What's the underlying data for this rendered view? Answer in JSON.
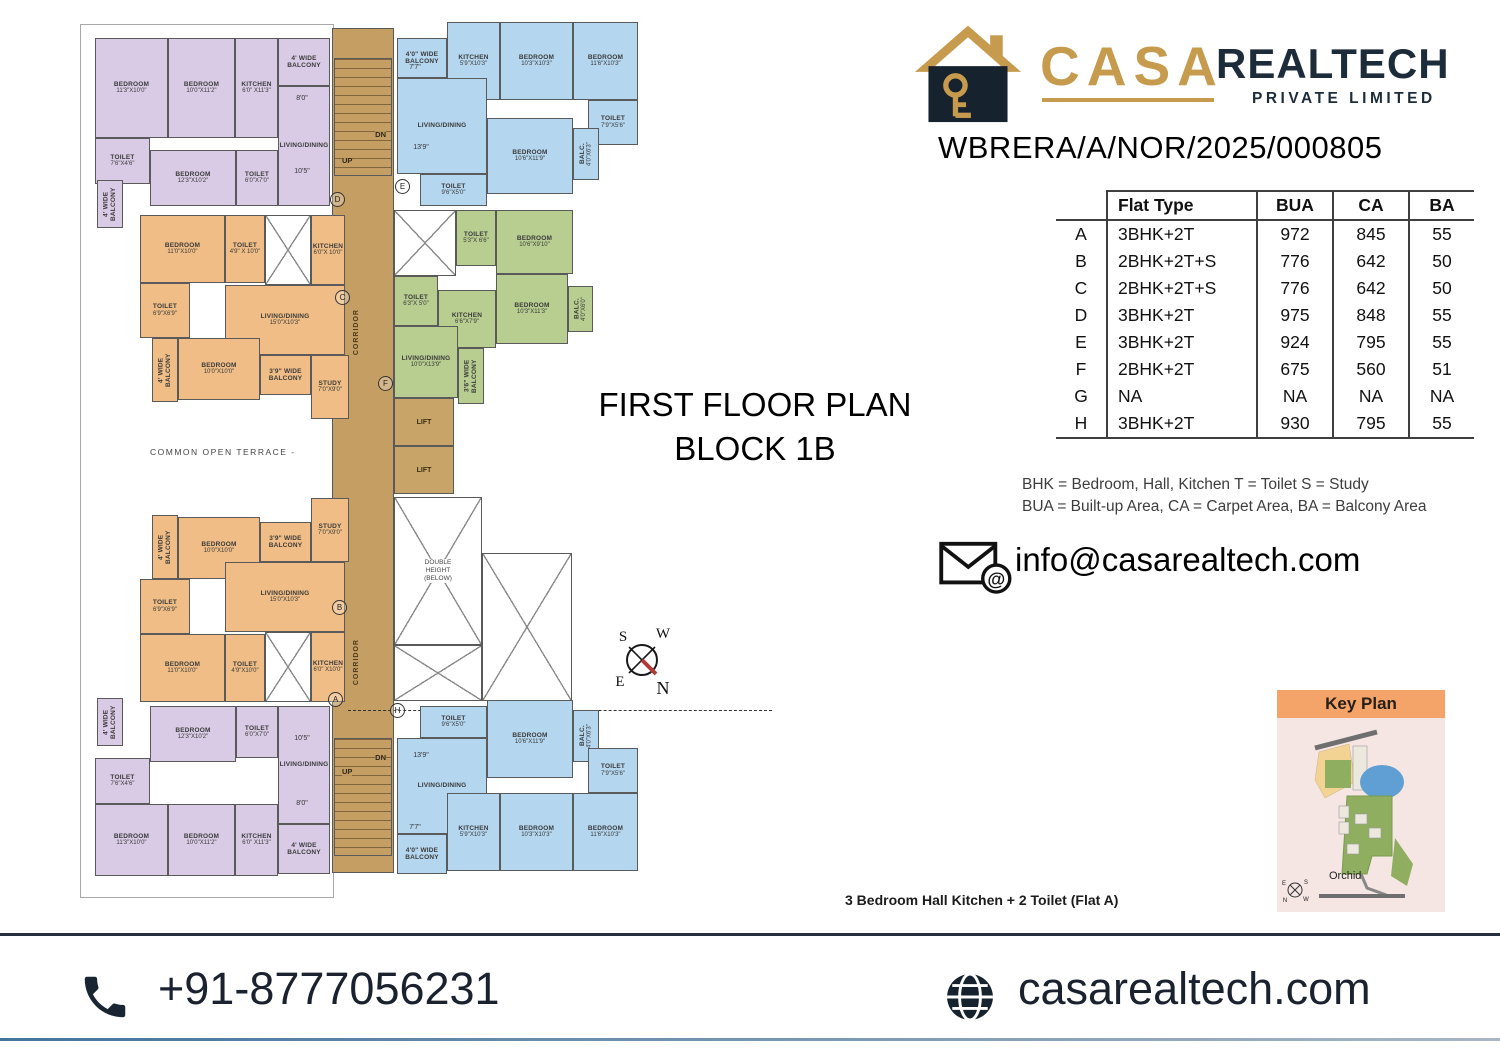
{
  "header": {
    "brand_casa": "CASA",
    "brand_realtech": "REALTECH",
    "brand_sub": "PRIVATE LIMITED",
    "rera": "WBRERA/A/NOR/2025/000805"
  },
  "area_table": {
    "columns": [
      "Flat Type",
      "BUA",
      "CA",
      "BA"
    ],
    "rows": [
      {
        "flat": "A",
        "type": "3BHK+2T",
        "bua": "972",
        "ca": "845",
        "ba": "55"
      },
      {
        "flat": "B",
        "type": "2BHK+2T+S",
        "bua": "776",
        "ca": "642",
        "ba": "50"
      },
      {
        "flat": "C",
        "type": "2BHK+2T+S",
        "bua": "776",
        "ca": "642",
        "ba": "50"
      },
      {
        "flat": "D",
        "type": "3BHK+2T",
        "bua": "975",
        "ca": "848",
        "ba": "55"
      },
      {
        "flat": "E",
        "type": "3BHK+2T",
        "bua": "924",
        "ca": "795",
        "ba": "55"
      },
      {
        "flat": "F",
        "type": "2BHK+2T",
        "bua": "675",
        "ca": "560",
        "ba": "51"
      },
      {
        "flat": "G",
        "type": "NA",
        "bua": "NA",
        "ca": "NA",
        "ba": "NA"
      },
      {
        "flat": "H",
        "type": "3BHK+2T",
        "bua": "930",
        "ca": "795",
        "ba": "55"
      }
    ]
  },
  "legend": {
    "line1": "BHK = Bedroom, Hall, Kitchen  T = Toilet  S = Study",
    "line2": "BUA = Built-up Area, CA = Carpet Area, BA = Balcony Area"
  },
  "contact": {
    "email": "info@casarealtech.com",
    "phone": "+91-8777056231",
    "website": "casarealtech.com"
  },
  "key_plan": {
    "title": "Key Plan",
    "label": "Orchid",
    "compass": {
      "tl": "E",
      "tr": "S",
      "bl": "N",
      "br": "W"
    }
  },
  "floor_plan": {
    "title_line1": "FIRST FLOOR PLAN",
    "title_line2": "BLOCK 1B",
    "caption": "3 Bedroom Hall Kitchen + 2 Toilet (Flat A)",
    "terrace_label": "COMMON  OPEN  TERRACE  -",
    "corridor_label": "CORRIDOR",
    "lift_label": "LIFT",
    "double_height_label": "DOUBLE HEIGHT (BELOW)",
    "stairs": {
      "dn": "DN",
      "up": "UP"
    },
    "compass": {
      "tl": "S",
      "tr": "W",
      "bl": "E",
      "br": "N"
    },
    "colors": {
      "p": "#d9cbe5",
      "b": "#b4d6ee",
      "g": "#b8cd90",
      "o": "#efbd85",
      "tan": "#c49e63",
      "wall": "#5a5a5a"
    },
    "rooms": [
      {
        "u": "D",
        "c": "p",
        "n": "BEDROOM",
        "d": "11'3\"X10'0\"",
        "x": 95,
        "y": 38,
        "w": 73,
        "h": 100
      },
      {
        "u": "D",
        "c": "p",
        "n": "BEDROOM",
        "d": "10'0\"X11'2\"",
        "x": 168,
        "y": 38,
        "w": 67,
        "h": 100
      },
      {
        "u": "D",
        "c": "p",
        "n": "KITCHEN",
        "d": "6'0\" X11'3\"",
        "x": 235,
        "y": 38,
        "w": 43,
        "h": 100
      },
      {
        "u": "D",
        "c": "p",
        "n": "4' WIDE BALCONY",
        "x": 278,
        "y": 38,
        "w": 52,
        "h": 48
      },
      {
        "u": "D",
        "c": "p",
        "n": "LIVING/DINING",
        "x": 278,
        "y": 86,
        "w": 52,
        "h": 120
      },
      {
        "u": "D",
        "c": "p",
        "n": "TOILET",
        "d": "7'6\"X4'6\"",
        "x": 95,
        "y": 138,
        "w": 55,
        "h": 46
      },
      {
        "u": "D",
        "c": "p",
        "n": "4' WIDE BALCONY",
        "vert": true,
        "x": 97,
        "y": 180,
        "w": 26,
        "h": 48
      },
      {
        "u": "D",
        "c": "p",
        "n": "BEDROOM",
        "d": "12'3\"X10'2\"",
        "x": 150,
        "y": 150,
        "w": 86,
        "h": 56
      },
      {
        "u": "D",
        "c": "p",
        "n": "TOILET",
        "d": "6'0\"X7'0\"",
        "x": 236,
        "y": 150,
        "w": 42,
        "h": 56
      },
      {
        "u": "E",
        "c": "b",
        "n": "4'0\" WIDE BALCONY",
        "x": 397,
        "y": 38,
        "w": 50,
        "h": 40
      },
      {
        "u": "E",
        "c": "b",
        "n": "KITCHEN",
        "d": "5'9\"X10'3\"",
        "x": 447,
        "y": 22,
        "w": 53,
        "h": 78
      },
      {
        "u": "E",
        "c": "b",
        "n": "BEDROOM",
        "d": "10'3\"X10'3\"",
        "x": 500,
        "y": 22,
        "w": 73,
        "h": 78
      },
      {
        "u": "E",
        "c": "b",
        "n": "BEDROOM",
        "d": "11'6\"X10'3\"",
        "x": 573,
        "y": 22,
        "w": 65,
        "h": 78
      },
      {
        "u": "E",
        "c": "b",
        "n": "LIVING/DINING",
        "x": 397,
        "y": 78,
        "w": 90,
        "h": 96
      },
      {
        "u": "E",
        "c": "b",
        "n": "TOILET",
        "d": "7'9\"X5'6\"",
        "x": 588,
        "y": 100,
        "w": 50,
        "h": 45
      },
      {
        "u": "E",
        "c": "b",
        "n": "BEDROOM",
        "d": "10'6\"X11'9\"",
        "x": 487,
        "y": 118,
        "w": 86,
        "h": 76
      },
      {
        "u": "E",
        "c": "b",
        "n": "BALC.",
        "d": "4'0\"X6'3\"",
        "vert": true,
        "x": 573,
        "y": 128,
        "w": 26,
        "h": 52
      },
      {
        "u": "E",
        "c": "b",
        "n": "TOILET",
        "d": "9'6\"X5'0\"",
        "x": 420,
        "y": 174,
        "w": 67,
        "h": 32
      },
      {
        "u": "F",
        "c": "g",
        "shaft": true,
        "x": 394,
        "y": 210,
        "w": 62,
        "h": 66
      },
      {
        "u": "F",
        "c": "g",
        "n": "TOILET",
        "d": "5'3\"X 6'6\"",
        "x": 456,
        "y": 210,
        "w": 40,
        "h": 56
      },
      {
        "u": "F",
        "c": "g",
        "n": "BEDROOM",
        "d": "10'6\"X9'10\"",
        "x": 496,
        "y": 210,
        "w": 77,
        "h": 64
      },
      {
        "u": "F",
        "c": "g",
        "n": "TOILET",
        "d": "6'3\"X 5'0\"",
        "x": 394,
        "y": 276,
        "w": 44,
        "h": 50
      },
      {
        "u": "F",
        "c": "g",
        "n": "BEDROOM",
        "d": "10'3\"X11'3\"",
        "x": 496,
        "y": 274,
        "w": 72,
        "h": 70
      },
      {
        "u": "F",
        "c": "g",
        "n": "BALC.",
        "d": "4'0\"X6'0\"",
        "vert": true,
        "x": 568,
        "y": 286,
        "w": 25,
        "h": 46
      },
      {
        "u": "F",
        "c": "g",
        "n": "KITCHEN",
        "d": "6'6\"X7'9\"",
        "x": 438,
        "y": 290,
        "w": 58,
        "h": 58
      },
      {
        "u": "F",
        "c": "g",
        "n": "LIVING/DINING",
        "d": "10'0\"X13'9\"",
        "x": 394,
        "y": 326,
        "w": 64,
        "h": 72
      },
      {
        "u": "F",
        "c": "g",
        "n": "3'6\" WIDE BALCONY",
        "vert": true,
        "x": 458,
        "y": 348,
        "w": 26,
        "h": 56
      },
      {
        "u": "C",
        "c": "o",
        "n": "BEDROOM",
        "d": "11'0\"X10'0\"",
        "x": 140,
        "y": 215,
        "w": 85,
        "h": 68
      },
      {
        "u": "C",
        "c": "o",
        "n": "TOILET",
        "d": "4'9\" X 10'0\"",
        "x": 225,
        "y": 215,
        "w": 40,
        "h": 68
      },
      {
        "u": "C",
        "c": "o",
        "shaft": true,
        "x": 265,
        "y": 215,
        "w": 46,
        "h": 70
      },
      {
        "u": "C",
        "c": "o",
        "n": "KITCHEN",
        "d": "6'0\"X 10'0\"",
        "x": 311,
        "y": 215,
        "w": 34,
        "h": 70
      },
      {
        "u": "C",
        "c": "o",
        "n": "TOILET",
        "d": "6'9\"X6'9\"",
        "x": 140,
        "y": 283,
        "w": 50,
        "h": 55
      },
      {
        "u": "C",
        "c": "o",
        "n": "LIVING/DINING",
        "d": "15'0\"X10'3\"",
        "x": 225,
        "y": 285,
        "w": 120,
        "h": 70
      },
      {
        "u": "C",
        "c": "o",
        "n": "4' WIDE BALCONY",
        "vert": true,
        "x": 152,
        "y": 338,
        "w": 26,
        "h": 64
      },
      {
        "u": "C",
        "c": "o",
        "n": "BEDROOM",
        "d": "10'0\"X10'0\"",
        "x": 178,
        "y": 338,
        "w": 82,
        "h": 62
      },
      {
        "u": "C",
        "c": "o",
        "n": "3'9\" WIDE BALCONY",
        "x": 260,
        "y": 355,
        "w": 51,
        "h": 40
      },
      {
        "u": "C",
        "c": "o",
        "n": "STUDY",
        "d": "7'0\"X9'0\"",
        "x": 311,
        "y": 355,
        "w": 38,
        "h": 64
      },
      {
        "u": "B",
        "c": "o",
        "n": "STUDY",
        "d": "7'0\"X9'0\"",
        "x": 311,
        "y": 498,
        "w": 38,
        "h": 64
      },
      {
        "u": "B",
        "c": "o",
        "n": "3'9\" WIDE BALCONY",
        "x": 260,
        "y": 522,
        "w": 51,
        "h": 40
      },
      {
        "u": "B",
        "c": "o",
        "n": "BEDROOM",
        "d": "10'0\"X10'0\"",
        "x": 178,
        "y": 517,
        "w": 82,
        "h": 62
      },
      {
        "u": "B",
        "c": "o",
        "n": "4' WIDE BALCONY",
        "vert": true,
        "x": 152,
        "y": 515,
        "w": 26,
        "h": 64
      },
      {
        "u": "B",
        "c": "o",
        "n": "LIVING/DINING",
        "d": "15'0\"X10'3\"",
        "x": 225,
        "y": 562,
        "w": 120,
        "h": 70
      },
      {
        "u": "B",
        "c": "o",
        "n": "TOILET",
        "d": "6'9\"X6'9\"",
        "x": 140,
        "y": 579,
        "w": 50,
        "h": 55
      },
      {
        "u": "B",
        "c": "o",
        "n": "BEDROOM",
        "d": "11'0\"X10'0\"",
        "x": 140,
        "y": 634,
        "w": 85,
        "h": 68
      },
      {
        "u": "B",
        "c": "o",
        "n": "TOILET",
        "d": "4'9\"X10'0\"",
        "x": 225,
        "y": 634,
        "w": 40,
        "h": 68
      },
      {
        "u": "B",
        "c": "o",
        "shaft": true,
        "x": 265,
        "y": 632,
        "w": 46,
        "h": 70
      },
      {
        "u": "B",
        "c": "o",
        "n": "KITCHEN",
        "d": "6'0\" X10'0\"",
        "x": 311,
        "y": 632,
        "w": 34,
        "h": 70
      },
      {
        "u": "A",
        "c": "p",
        "n": "TOILET",
        "d": "6'0\"X7'0\"",
        "x": 236,
        "y": 706,
        "w": 42,
        "h": 52
      },
      {
        "u": "A",
        "c": "p",
        "n": "BEDROOM",
        "d": "12'3\"X10'2\"",
        "x": 150,
        "y": 706,
        "w": 86,
        "h": 56
      },
      {
        "u": "A",
        "c": "p",
        "n": "4' WIDE BALCONY",
        "vert": true,
        "x": 97,
        "y": 698,
        "w": 26,
        "h": 48
      },
      {
        "u": "A",
        "c": "p",
        "n": "TOILET",
        "d": "7'6\"X4'6\"",
        "x": 95,
        "y": 758,
        "w": 55,
        "h": 46
      },
      {
        "u": "A",
        "c": "p",
        "n": "LIVING/DINING",
        "x": 278,
        "y": 706,
        "w": 52,
        "h": 118
      },
      {
        "u": "A",
        "c": "p",
        "n": "BEDROOM",
        "d": "11'3\"X10'0\"",
        "x": 95,
        "y": 804,
        "w": 73,
        "h": 72
      },
      {
        "u": "A",
        "c": "p",
        "n": "BEDROOM",
        "d": "10'0\"X11'2\"",
        "x": 168,
        "y": 804,
        "w": 67,
        "h": 72
      },
      {
        "u": "A",
        "c": "p",
        "n": "KITCHEN",
        "d": "6'0\" X11'3\"",
        "x": 235,
        "y": 804,
        "w": 43,
        "h": 72
      },
      {
        "u": "A",
        "c": "p",
        "n": "4' WIDE BALCONY",
        "x": 278,
        "y": 824,
        "w": 52,
        "h": 50
      },
      {
        "u": "H",
        "c": "b",
        "n": "TOILET",
        "d": "9'6\"X5'0\"",
        "x": 420,
        "y": 706,
        "w": 67,
        "h": 32
      },
      {
        "u": "H",
        "c": "b",
        "n": "BEDROOM",
        "d": "10'6\"X11'9\"",
        "x": 487,
        "y": 700,
        "w": 86,
        "h": 78
      },
      {
        "u": "H",
        "c": "b",
        "n": "BALC.",
        "d": "4'0\"X6'3\"",
        "vert": true,
        "x": 573,
        "y": 710,
        "w": 26,
        "h": 52
      },
      {
        "u": "H",
        "c": "b",
        "n": "LIVING/DINING",
        "x": 397,
        "y": 738,
        "w": 90,
        "h": 96
      },
      {
        "u": "H",
        "c": "b",
        "n": "TOILET",
        "d": "7'9\"X5'6\"",
        "x": 588,
        "y": 748,
        "w": 50,
        "h": 45
      },
      {
        "u": "H",
        "c": "b",
        "n": "4'0\" WIDE BALCONY",
        "x": 397,
        "y": 834,
        "w": 50,
        "h": 40
      },
      {
        "u": "H",
        "c": "b",
        "n": "KITCHEN",
        "d": "5'9\"X10'3\"",
        "x": 447,
        "y": 793,
        "w": 53,
        "h": 78
      },
      {
        "u": "H",
        "c": "b",
        "n": "BEDROOM",
        "d": "10'3\"X10'3\"",
        "x": 500,
        "y": 793,
        "w": 73,
        "h": 78
      },
      {
        "u": "H",
        "c": "b",
        "n": "BEDROOM",
        "d": "11'6\"X10'3\"",
        "x": 573,
        "y": 793,
        "w": 65,
        "h": 78
      }
    ],
    "markers": [
      {
        "l": "D",
        "x": 330,
        "y": 192
      },
      {
        "l": "C",
        "x": 335,
        "y": 290
      },
      {
        "l": "B",
        "x": 332,
        "y": 600
      },
      {
        "l": "A",
        "x": 328,
        "y": 692
      },
      {
        "l": "E",
        "x": 395,
        "y": 179
      },
      {
        "l": "F",
        "x": 378,
        "y": 376
      },
      {
        "l": "H",
        "x": 390,
        "y": 703
      }
    ],
    "dims": [
      {
        "t": "8'0\"",
        "x": 285,
        "y": 95
      },
      {
        "t": "10'5\"",
        "x": 285,
        "y": 168
      },
      {
        "t": "7'7\"",
        "x": 398,
        "y": 64
      },
      {
        "t": "13'9\"",
        "x": 404,
        "y": 144
      },
      {
        "t": "10'5\"",
        "x": 285,
        "y": 735
      },
      {
        "t": "8'0\"",
        "x": 285,
        "y": 800
      },
      {
        "t": "13'9\"",
        "x": 404,
        "y": 752
      },
      {
        "t": "7'7\"",
        "x": 398,
        "y": 824
      }
    ]
  }
}
